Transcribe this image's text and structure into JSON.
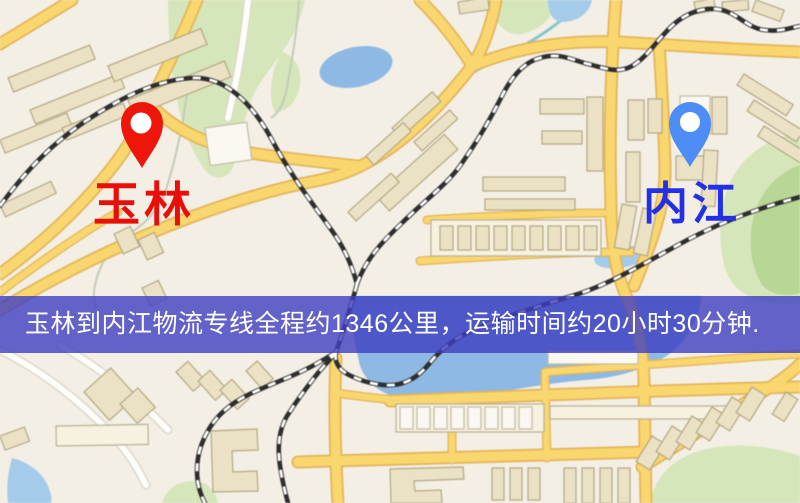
{
  "map": {
    "markers": {
      "origin": {
        "label": "玉林",
        "icon": "map-pin",
        "pin_color": "#ee150b",
        "label_color": "#e80f08"
      },
      "destination": {
        "label": "内江",
        "icon": "map-pin",
        "pin_color": "#4f8df6",
        "label_color": "#2231e8"
      }
    },
    "banner": {
      "text": "玉林到内江物流专线全程约1346公里，运输时间约20小时30分钟.",
      "background_color": "#3e3ec0",
      "text_color": "#ffffff",
      "distance_km": "1346",
      "duration": "20小时30分钟"
    },
    "palette": {
      "land": "#f3efe5",
      "road": "#f8d672",
      "road_casing": "#e2b45e",
      "railway": "#2e2e2e",
      "park": "#d6e6bc",
      "water": "#8fb9e2",
      "building": "#ebe2c6"
    }
  }
}
